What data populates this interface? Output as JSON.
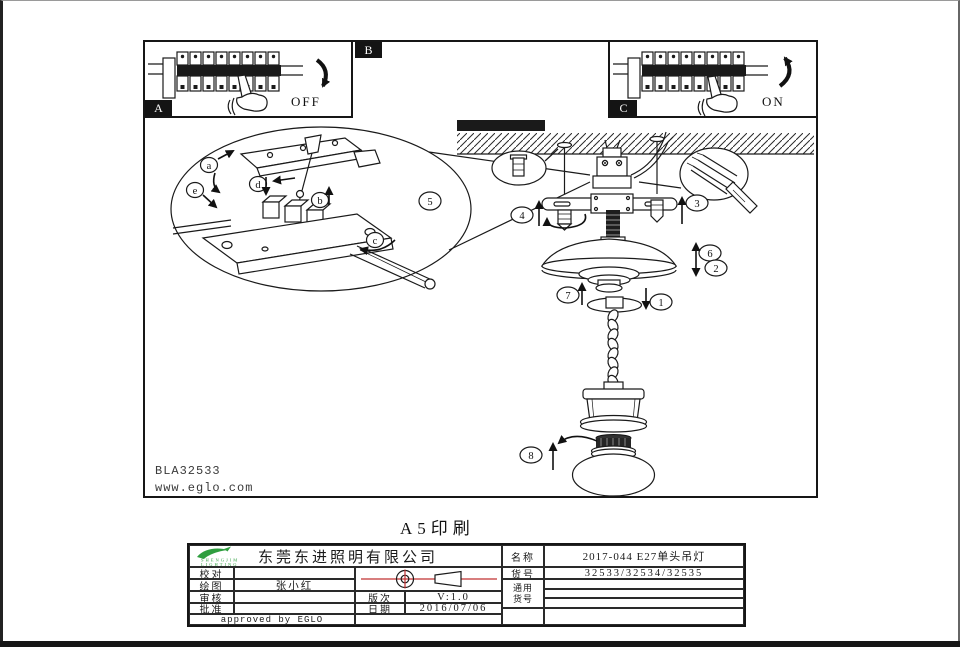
{
  "page": {
    "print_note": "A5印刷"
  },
  "panels": {
    "a": {
      "tab": "A",
      "switch_label": "OFF"
    },
    "b": {
      "tab": "B"
    },
    "c": {
      "tab": "C",
      "switch_label": "ON"
    }
  },
  "drawing": {
    "code": "BLA32533",
    "website": "www.eglo.com",
    "callout_numbers": [
      "1",
      "2",
      "3",
      "4",
      "5",
      "6",
      "7",
      "8"
    ],
    "callout_letters": [
      "a",
      "b",
      "c",
      "d",
      "e"
    ]
  },
  "title_block": {
    "company": "东莞东进照明有限公司",
    "logo": {
      "line1": "SHENGJIM",
      "line2": "LIGHTING"
    },
    "check_label": "校对",
    "draw_label": "绘图",
    "draw_value": "张小红",
    "review_label": "审核",
    "approve_label": "批准",
    "approved_note": "approved by EGLO",
    "revision_label": "版次",
    "revision_value": "V:1.0",
    "date_label": "日期",
    "date_value": "2016/07/06",
    "name_label": "名称",
    "name_value": "2017-044 E27单头吊灯",
    "item_label": "货号",
    "item_value": "32533/32534/32535",
    "generic_label_1": "通用",
    "generic_label_2": "货号"
  },
  "colors": {
    "ink": "#1a1a1a",
    "accent_red": "#c03030",
    "logo_green": "#2f9e3f"
  }
}
